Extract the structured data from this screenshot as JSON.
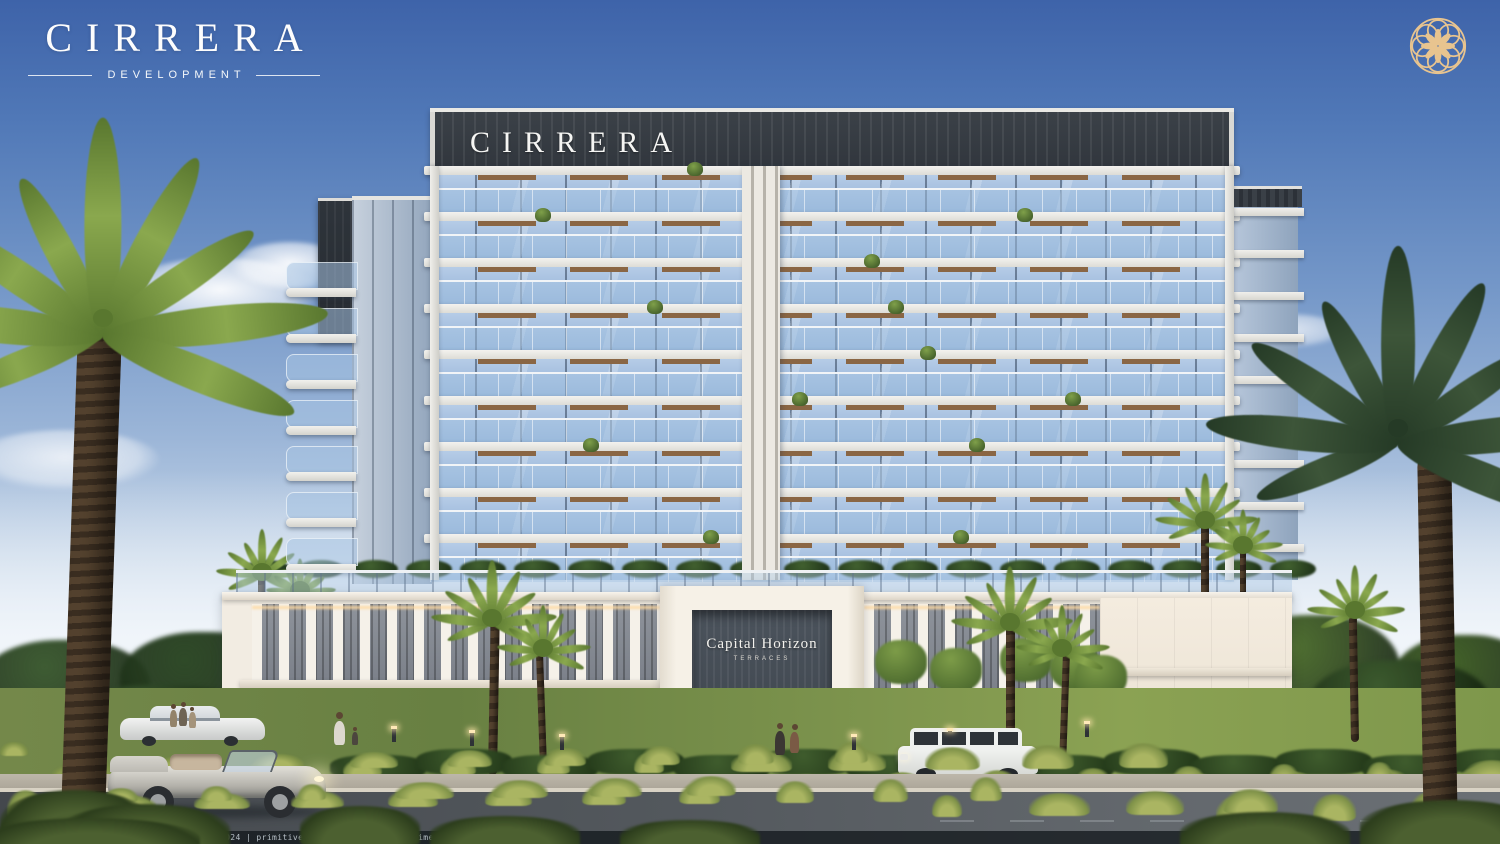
{
  "brand": {
    "name": "CIRRERA",
    "division": "DEVELOPMENT",
    "emblem": "gold-rosette"
  },
  "building": {
    "rooftop_sign": "CIRRERA",
    "entrance_sign": {
      "title": "Capital Horizon",
      "subtitle": "TERRACES"
    }
  },
  "footer": {
    "render_info": "S/S DUBAI | VIEW RENDER | C.max | frame: 0024 | primitives: 21545714 | render time: 1h 20m 11.1s"
  },
  "colors": {
    "gold": "#e8c48f",
    "sky_top": "#3e63a9",
    "sky_horizon": "#eef2f5",
    "facade_dark_band": "#343a41",
    "facade_slab": "#f0efeb",
    "glass": "#9fbadd",
    "podium_cream": "#f2ece2",
    "road": "#53585d",
    "lawn": "#7b924c",
    "palm_green": "#6f8f3f"
  }
}
